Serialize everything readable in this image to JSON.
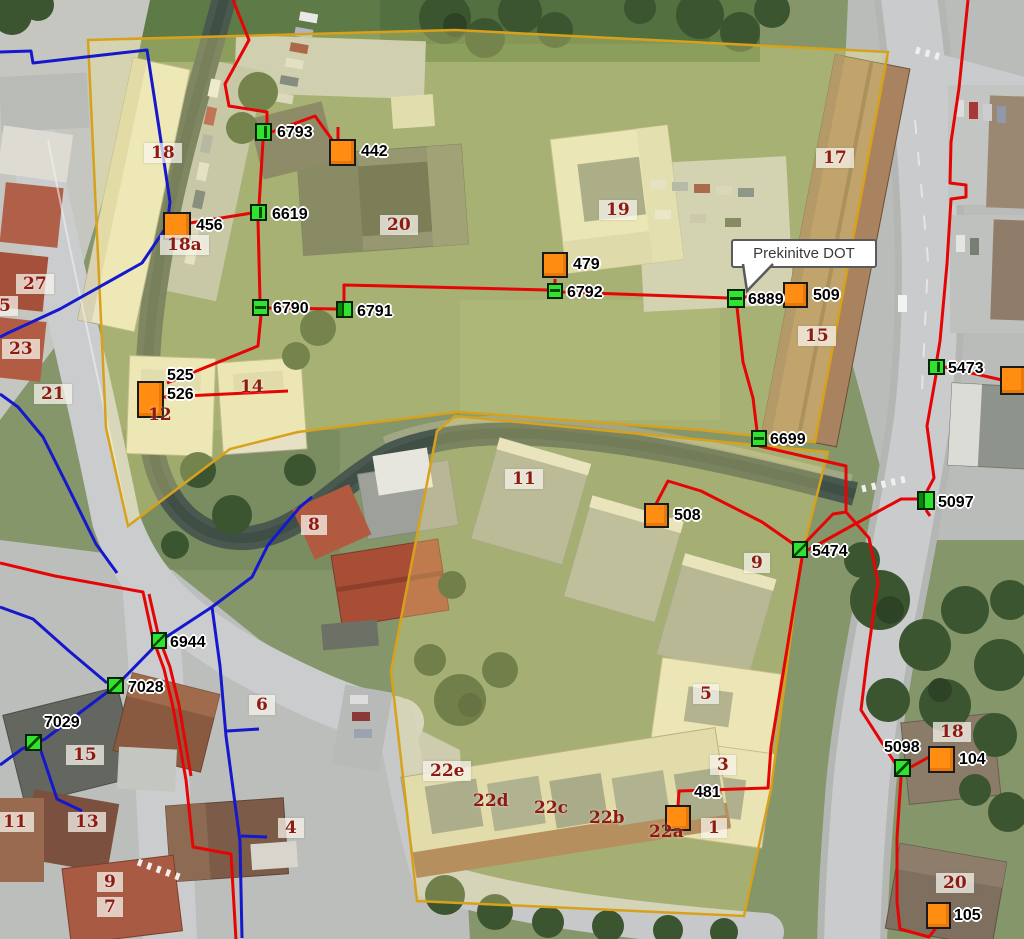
{
  "map": {
    "tooltip": {
      "text": "Prekinitve DOT",
      "x": 731,
      "y": 239,
      "w": 146,
      "h": 29
    },
    "colors": {
      "red_line": "#e60505",
      "blue_line": "#1518cd",
      "orange_node": "#ff8d12",
      "green_node": "#2fe32f",
      "parcel_stroke": "#d7a11c",
      "building_label": "#8e1a12",
      "node_label": "#000000"
    },
    "network_nodes": [
      {
        "id": "6793",
        "style": "green",
        "variant": "v",
        "x": 255,
        "y": 123,
        "w": 17,
        "h": 18,
        "labels": [
          {
            "text": "6793",
            "x": 277,
            "y": 124
          }
        ]
      },
      {
        "id": "6619",
        "style": "green",
        "variant": "v",
        "x": 250,
        "y": 204,
        "w": 17,
        "h": 17,
        "labels": [
          {
            "text": "6619",
            "x": 272,
            "y": 206
          }
        ]
      },
      {
        "id": "6790",
        "style": "green",
        "variant": "h",
        "x": 252,
        "y": 299,
        "w": 17,
        "h": 17,
        "labels": [
          {
            "text": "6790",
            "x": 273,
            "y": 300
          }
        ]
      },
      {
        "id": "6791",
        "style": "green",
        "variant": "l",
        "x": 336,
        "y": 301,
        "w": 17,
        "h": 17,
        "labels": [
          {
            "text": "6791",
            "x": 357,
            "y": 303
          }
        ]
      },
      {
        "id": "6792",
        "style": "green",
        "variant": "h",
        "x": 547,
        "y": 283,
        "w": 16,
        "h": 16,
        "labels": [
          {
            "text": "6792",
            "x": 567,
            "y": 284
          }
        ]
      },
      {
        "id": "6889",
        "style": "green",
        "variant": "h",
        "x": 727,
        "y": 289,
        "w": 18,
        "h": 19,
        "labels": [
          {
            "text": "6889",
            "x": 748,
            "y": 291
          }
        ]
      },
      {
        "id": "6699",
        "style": "green",
        "variant": "h",
        "x": 751,
        "y": 430,
        "w": 16,
        "h": 17,
        "labels": [
          {
            "text": "6699",
            "x": 770,
            "y": 431
          }
        ]
      },
      {
        "id": "5474",
        "style": "green",
        "variant": "d",
        "x": 792,
        "y": 541,
        "w": 16,
        "h": 17,
        "labels": [
          {
            "text": "5474",
            "x": 812,
            "y": 543
          }
        ]
      },
      {
        "id": "5473",
        "style": "green",
        "variant": "v",
        "x": 928,
        "y": 359,
        "w": 17,
        "h": 16,
        "labels": [
          {
            "text": "5473",
            "x": 948,
            "y": 360
          }
        ]
      },
      {
        "id": "5097",
        "style": "green",
        "variant": "l",
        "x": 917,
        "y": 491,
        "w": 18,
        "h": 19,
        "labels": [
          {
            "text": "5097",
            "x": 938,
            "y": 494
          }
        ]
      },
      {
        "id": "6944",
        "style": "green",
        "variant": "d",
        "x": 151,
        "y": 632,
        "w": 16,
        "h": 17,
        "labels": [
          {
            "text": "6944",
            "x": 170,
            "y": 634
          }
        ]
      },
      {
        "id": "7028",
        "style": "green",
        "variant": "d",
        "x": 107,
        "y": 677,
        "w": 17,
        "h": 17,
        "labels": [
          {
            "text": "7028",
            "x": 128,
            "y": 679
          }
        ]
      },
      {
        "id": "7029",
        "style": "green",
        "variant": "d",
        "x": 25,
        "y": 734,
        "w": 17,
        "h": 17,
        "labels": [
          {
            "text": "7029",
            "x": 44,
            "y": 714
          }
        ]
      },
      {
        "id": "5098",
        "style": "green",
        "variant": "d",
        "x": 894,
        "y": 759,
        "w": 17,
        "h": 18,
        "labels": [
          {
            "text": "5098",
            "x": 884,
            "y": 739
          }
        ]
      },
      {
        "id": "442",
        "style": "orange",
        "x": 329,
        "y": 139,
        "w": 27,
        "h": 27,
        "labels": [
          {
            "text": "442",
            "x": 361,
            "y": 143
          }
        ]
      },
      {
        "id": "456",
        "style": "orange",
        "x": 163,
        "y": 212,
        "w": 28,
        "h": 28,
        "labels": [
          {
            "text": "456",
            "x": 196,
            "y": 217
          }
        ]
      },
      {
        "id": "479",
        "style": "orange",
        "x": 542,
        "y": 252,
        "w": 26,
        "h": 26,
        "labels": [
          {
            "text": "479",
            "x": 573,
            "y": 256
          }
        ]
      },
      {
        "id": "509",
        "style": "orange",
        "x": 783,
        "y": 282,
        "w": 25,
        "h": 26,
        "labels": [
          {
            "text": "509",
            "x": 813,
            "y": 287
          }
        ]
      },
      {
        "id": "508",
        "style": "orange",
        "x": 644,
        "y": 503,
        "w": 25,
        "h": 25,
        "labels": [
          {
            "text": "508",
            "x": 674,
            "y": 507
          }
        ]
      },
      {
        "id": "525-526",
        "style": "orange",
        "x": 137,
        "y": 381,
        "w": 27,
        "h": 37,
        "labels": [
          {
            "text": "525",
            "x": 167,
            "y": 367
          },
          {
            "text": "526",
            "x": 167,
            "y": 386
          }
        ]
      },
      {
        "id": "104",
        "style": "orange",
        "x": 928,
        "y": 746,
        "w": 27,
        "h": 27,
        "labels": [
          {
            "text": "104",
            "x": 959,
            "y": 751
          }
        ]
      },
      {
        "id": "105",
        "style": "orange",
        "x": 926,
        "y": 902,
        "w": 25,
        "h": 27,
        "labels": [
          {
            "text": "105",
            "x": 954,
            "y": 907
          }
        ]
      },
      {
        "id": "481",
        "style": "orange",
        "x": 665,
        "y": 805,
        "w": 26,
        "h": 26,
        "labels": [
          {
            "text": "481",
            "x": 694,
            "y": 784
          }
        ]
      },
      {
        "id": "edge",
        "style": "orange",
        "x": 1000,
        "y": 366,
        "w": 26,
        "h": 29,
        "labels": []
      }
    ],
    "building_labels": [
      {
        "text": "18",
        "x": 144,
        "y": 143,
        "boxed": true
      },
      {
        "text": "18a",
        "x": 160,
        "y": 235,
        "boxed": true
      },
      {
        "text": "20",
        "x": 380,
        "y": 215,
        "boxed": true
      },
      {
        "text": "19",
        "x": 599,
        "y": 200,
        "boxed": true
      },
      {
        "text": "17",
        "x": 816,
        "y": 148,
        "boxed": true
      },
      {
        "text": "15",
        "x": 798,
        "y": 326,
        "boxed": true
      },
      {
        "text": "27",
        "x": 16,
        "y": 274,
        "boxed": true
      },
      {
        "text": "5",
        "x": -8,
        "y": 296,
        "boxed": true
      },
      {
        "text": "23",
        "x": 2,
        "y": 339,
        "boxed": true
      },
      {
        "text": "21",
        "x": 34,
        "y": 384,
        "boxed": true
      },
      {
        "text": "12",
        "x": 148,
        "y": 405,
        "boxed": false
      },
      {
        "text": "14",
        "x": 240,
        "y": 377,
        "boxed": false
      },
      {
        "text": "8",
        "x": 301,
        "y": 515,
        "boxed": true
      },
      {
        "text": "11",
        "x": 505,
        "y": 469,
        "boxed": true
      },
      {
        "text": "9",
        "x": 744,
        "y": 553,
        "boxed": true
      },
      {
        "text": "5",
        "x": 693,
        "y": 684,
        "boxed": true
      },
      {
        "text": "3",
        "x": 710,
        "y": 755,
        "boxed": true
      },
      {
        "text": "1",
        "x": 701,
        "y": 818,
        "boxed": true
      },
      {
        "text": "22a",
        "x": 649,
        "y": 822,
        "boxed": false
      },
      {
        "text": "22b",
        "x": 589,
        "y": 808,
        "boxed": false
      },
      {
        "text": "22c",
        "x": 534,
        "y": 798,
        "boxed": false
      },
      {
        "text": "22d",
        "x": 473,
        "y": 791,
        "boxed": false
      },
      {
        "text": "22e",
        "x": 423,
        "y": 761,
        "boxed": true
      },
      {
        "text": "6",
        "x": 249,
        "y": 695,
        "boxed": true
      },
      {
        "text": "4",
        "x": 278,
        "y": 818,
        "boxed": true
      },
      {
        "text": "15",
        "x": 66,
        "y": 745,
        "boxed": true
      },
      {
        "text": "13",
        "x": 68,
        "y": 812,
        "boxed": true
      },
      {
        "text": "11",
        "x": -4,
        "y": 812,
        "boxed": true
      },
      {
        "text": "9",
        "x": 97,
        "y": 872,
        "boxed": true
      },
      {
        "text": "7",
        "x": 97,
        "y": 897,
        "boxed": true
      },
      {
        "text": "18",
        "x": 933,
        "y": 722,
        "boxed": true
      },
      {
        "text": "20",
        "x": 936,
        "y": 873,
        "boxed": true
      }
    ]
  }
}
